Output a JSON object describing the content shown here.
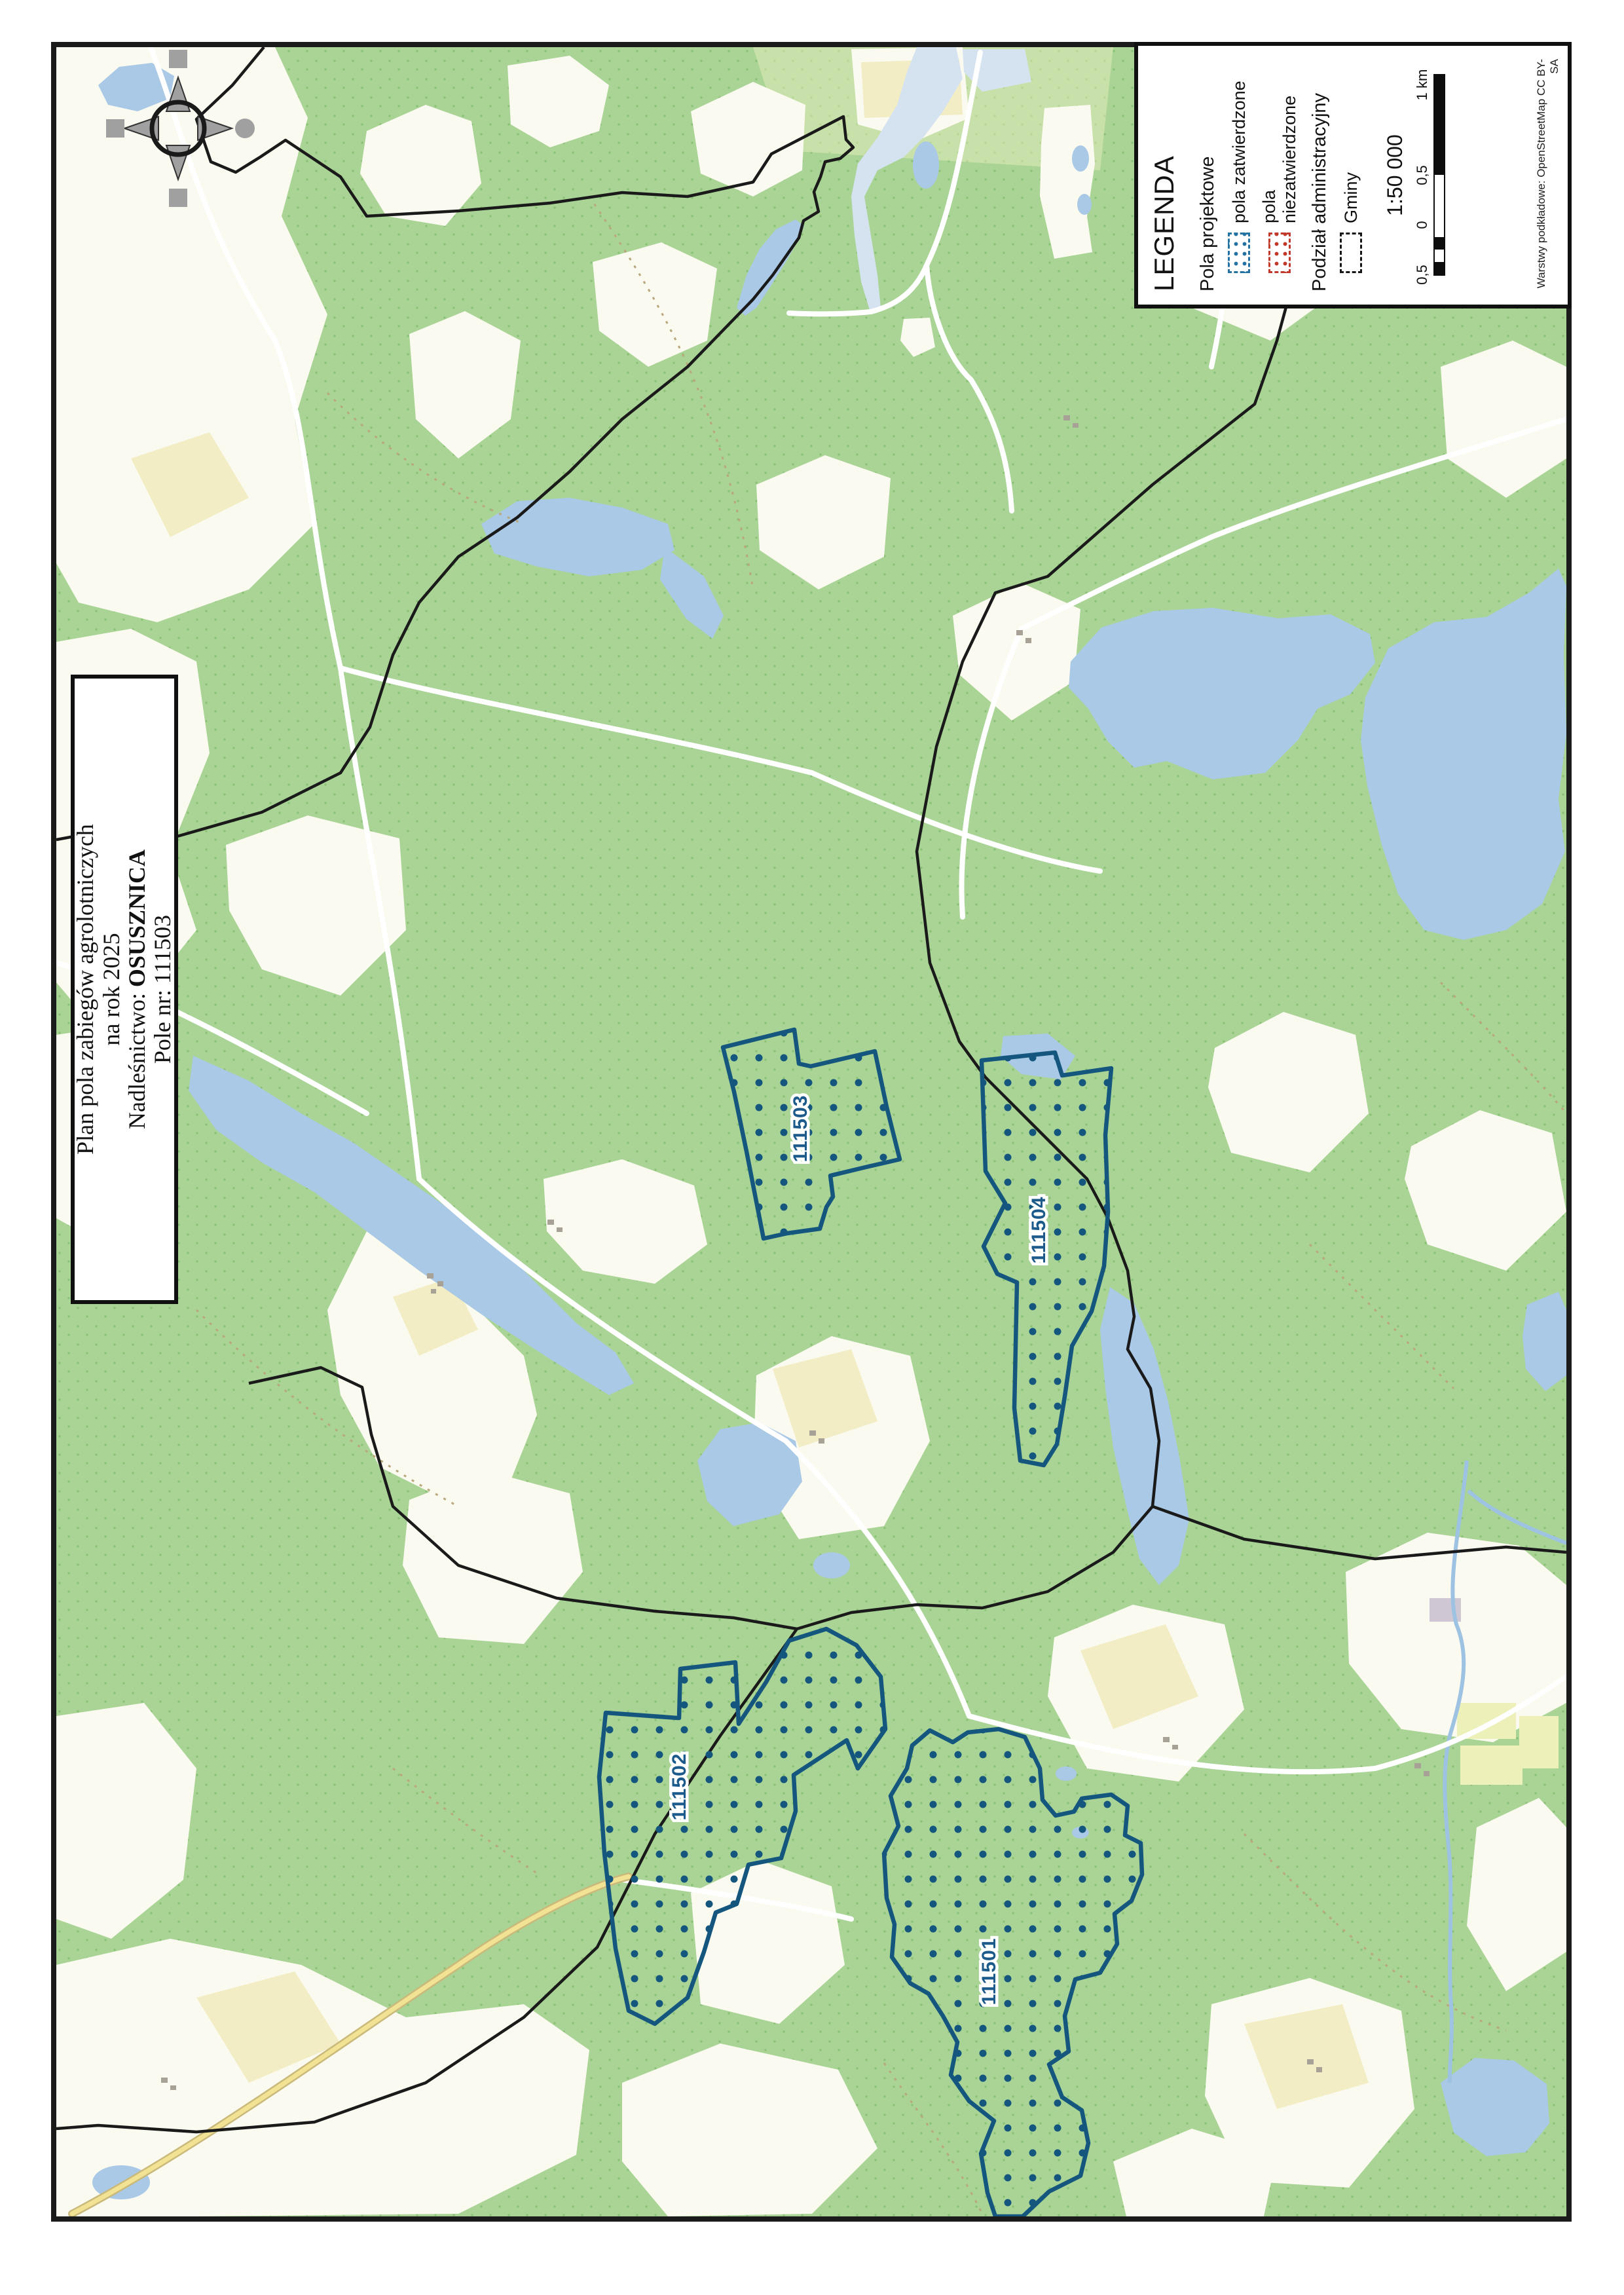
{
  "title_box": {
    "line1": "Plan pola zabiegów agrolotniczych",
    "line2": "na rok 2025",
    "nadlesnictwo_label": "Nadleśnictwo:",
    "nadlesnictwo_value": "OSUSZNICA",
    "pole_line": "Pole nr: 111503"
  },
  "legend": {
    "title": "LEGENDA",
    "section_fields": "Pola projektowe",
    "approved": "pola zatwierdzone",
    "unapproved": "pola niezatwierdzone",
    "section_admin": "Podział administracyjny",
    "gminy": "Gminy",
    "scale": "1:50 000",
    "bar_labels": [
      "0,5",
      "0",
      "0,5",
      "1 km"
    ],
    "attribution": "Warstwy podkładowe: OpenStreetMap CC BY-SA"
  },
  "fields": [
    {
      "id": "111501"
    },
    {
      "id": "111502"
    },
    {
      "id": "111503"
    },
    {
      "id": "111504"
    }
  ],
  "colors": {
    "field_blue": "#14567e",
    "unapproved_red": "#c0392b",
    "forest_green": "#a9d495",
    "water_blue": "#a9c9e6",
    "admin_black": "#1a1a1a"
  }
}
